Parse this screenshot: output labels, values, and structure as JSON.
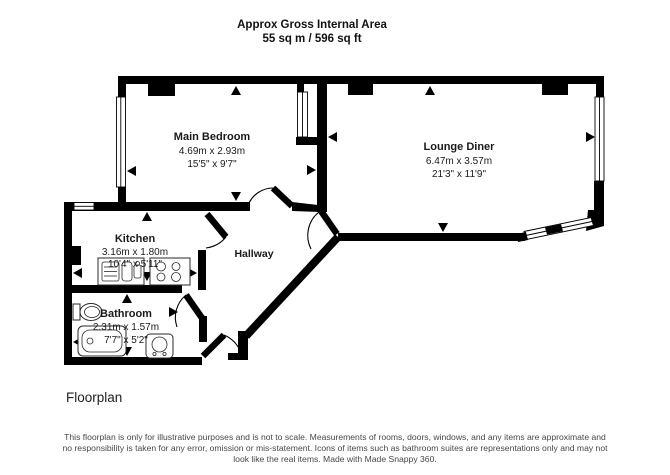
{
  "title": {
    "line1": "Approx Gross Internal Area",
    "line2": "55 sq m / 596 sq ft"
  },
  "rooms": {
    "main_bedroom": {
      "name": "Main Bedroom",
      "metric": "4.69m x 2.93m",
      "imperial": "15'5\" x 9'7\""
    },
    "lounge_diner": {
      "name": "Lounge Diner",
      "metric": "6.47m x 3.57m",
      "imperial": "21'3\" x 11'9\""
    },
    "kitchen": {
      "name": "Kitchen",
      "metric": "3.16m x 1.80m",
      "imperial": "10'4\" x 5'11\""
    },
    "bathroom": {
      "name": "Bathroom",
      "metric": "2.31m x 1.57m",
      "imperial": "7'7\" x 5'2\""
    },
    "hallway": {
      "name": "Hallway"
    }
  },
  "caption": "Floorplan",
  "disclaimer": "This floorplan is only for illustrative purposes and is not to scale. Measurements of rooms, doors, windows, and any items are approximate and no responsibility is taken for any error, omission or mis-statement. Icons of items such as bathroom suites are representations only and may not look like the real items. Made with Made Snappy 360.",
  "colors": {
    "wall": "#000000",
    "background": "#ffffff",
    "text": "#1a1a1a",
    "disclaimer_text": "#474747"
  }
}
